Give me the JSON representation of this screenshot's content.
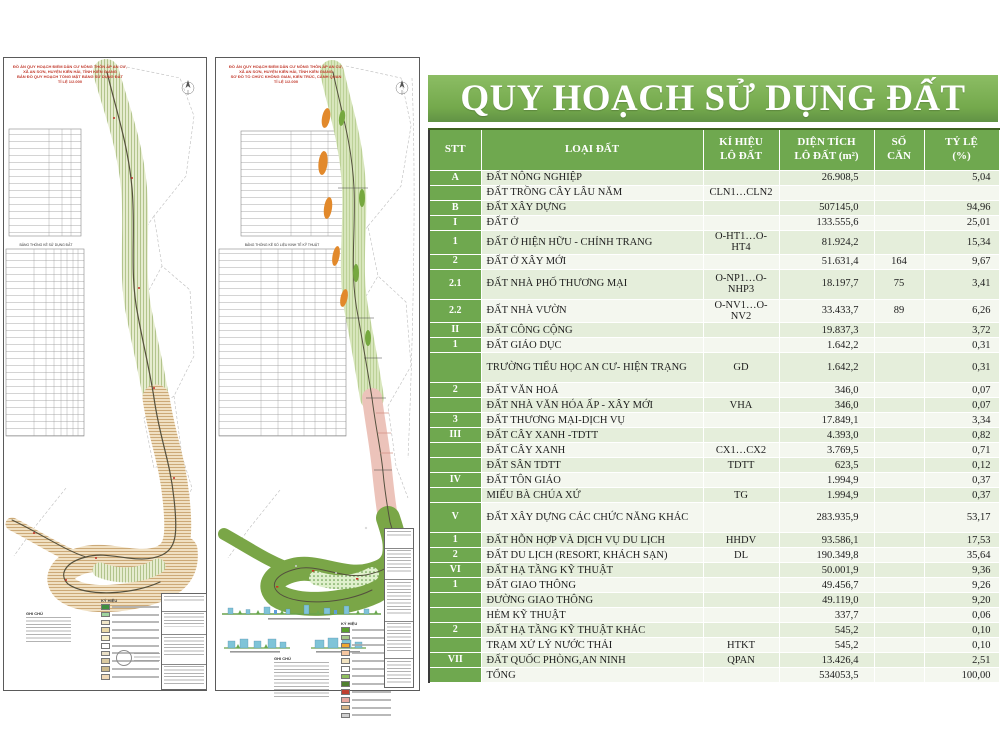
{
  "banner": {
    "title": "QUY HOẠCH SỬ DỤNG ĐẤT"
  },
  "colors": {
    "banner_green": "#74a94c",
    "header_green": "#6fa84f",
    "row_band_green": "#e5eedb",
    "row_band_light": "#f4f7ef",
    "map_tan": "#f0e0c2",
    "map_green_hatch": "#e6eccf",
    "map_solid_green": "#7aa647",
    "map_pink": "#ecc3ba",
    "map_orange": "#e2892b",
    "red_note_text": "#c23b2e"
  },
  "table": {
    "headers": {
      "stt": "STT",
      "loai": "LOẠI ĐẤT",
      "kihieu": "KÍ HIỆU\nLÔ ĐẤT",
      "dientich": "DIỆN TÍCH\nLÔ ĐẤT (m²)",
      "socan": "SỐ\nCĂN",
      "tyle": "TỶ LỆ\n(%)"
    },
    "rows": [
      {
        "stt": "A",
        "loai": "ĐẤT NÔNG NGHIỆP",
        "kihieu": "",
        "dientich": "26.908,5",
        "socan": "",
        "tyle": "5,04"
      },
      {
        "stt": "",
        "loai": "ĐẤT TRỒNG CÂY LÂU NĂM",
        "kihieu": "CLN1…CLN2",
        "dientich": "",
        "socan": "",
        "tyle": ""
      },
      {
        "stt": "B",
        "loai": "ĐẤT XÂY DỰNG",
        "kihieu": "",
        "dientich": "507145,0",
        "socan": "",
        "tyle": "94,96"
      },
      {
        "stt": "I",
        "loai": "ĐẤT Ở",
        "kihieu": "",
        "dientich": "133.555,6",
        "socan": "",
        "tyle": "25,01"
      },
      {
        "stt": "1",
        "loai": "ĐẤT Ở HIỆN HỮU - CHỈNH TRANG",
        "kihieu": "O-HT1…O-HT4",
        "dientich": "81.924,2",
        "socan": "",
        "tyle": "15,34"
      },
      {
        "stt": "2",
        "loai": "ĐẤT Ở XÂY MỚI",
        "kihieu": "",
        "dientich": "51.631,4",
        "socan": "164",
        "tyle": "9,67"
      },
      {
        "stt": "2.1",
        "loai": "ĐẤT NHÀ PHỐ THƯƠNG MẠI",
        "kihieu": "O-NP1…O-NHP3",
        "dientich": "18.197,7",
        "socan": "75",
        "tyle": "3,41",
        "tall": true
      },
      {
        "stt": "2.2",
        "loai": "ĐẤT NHÀ VƯỜN",
        "kihieu": "O-NV1…O-NV2",
        "dientich": "33.433,7",
        "socan": "89",
        "tyle": "6,26"
      },
      {
        "stt": "II",
        "loai": "ĐẤT CÔNG CỘNG",
        "kihieu": "",
        "dientich": "19.837,3",
        "socan": "",
        "tyle": "3,72"
      },
      {
        "stt": "1",
        "loai": "ĐẤT GIÁO DỤC",
        "kihieu": "",
        "dientich": "1.642,2",
        "socan": "",
        "tyle": "0,31"
      },
      {
        "stt": "",
        "loai": "TRƯỜNG TIỂU HỌC AN CƯ- HIỆN TRẠNG",
        "kihieu": "GD",
        "dientich": "1.642,2",
        "socan": "",
        "tyle": "0,31",
        "tall": true
      },
      {
        "stt": "2",
        "loai": "ĐẤT VĂN HOÁ",
        "kihieu": "",
        "dientich": "346,0",
        "socan": "",
        "tyle": "0,07"
      },
      {
        "stt": "",
        "loai": "ĐẤT NHÀ VĂN HÓA ẤP - XÂY MỚI",
        "kihieu": "VHA",
        "dientich": "346,0",
        "socan": "",
        "tyle": "0,07"
      },
      {
        "stt": "3",
        "loai": "ĐẤT THƯƠNG MẠI-DỊCH VỤ",
        "kihieu": "",
        "dientich": "17.849,1",
        "socan": "",
        "tyle": "3,34"
      },
      {
        "stt": "III",
        "loai": "ĐẤT CÂY XANH -TDTT",
        "kihieu": "",
        "dientich": "4.393,0",
        "socan": "",
        "tyle": "0,82"
      },
      {
        "stt": "",
        "loai": "ĐẤT CÂY XANH",
        "kihieu": "CX1…CX2",
        "dientich": "3.769,5",
        "socan": "",
        "tyle": "0,71"
      },
      {
        "stt": "",
        "loai": "ĐẤT SÂN TDTT",
        "kihieu": "TDTT",
        "dientich": "623,5",
        "socan": "",
        "tyle": "0,12"
      },
      {
        "stt": "IV",
        "loai": "ĐẤT TÔN GIÁO",
        "kihieu": "",
        "dientich": "1.994,9",
        "socan": "",
        "tyle": "0,37"
      },
      {
        "stt": "",
        "loai": "MIẾU BÀ CHÚA XỨ",
        "kihieu": "TG",
        "dientich": "1.994,9",
        "socan": "",
        "tyle": "0,37"
      },
      {
        "stt": "V",
        "loai": "ĐẤT XÂY DỰNG CÁC CHỨC NĂNG KHÁC",
        "kihieu": "",
        "dientich": "283.935,9",
        "socan": "",
        "tyle": "53,17",
        "tall": true
      },
      {
        "stt": "1",
        "loai": "ĐẤT HỖN HỢP VÀ DỊCH VỤ DU LỊCH",
        "kihieu": "HHDV",
        "dientich": "93.586,1",
        "socan": "",
        "tyle": "17,53"
      },
      {
        "stt": "2",
        "loai": "ĐẤT DU LỊCH (RESORT, KHÁCH SẠN)",
        "kihieu": "DL",
        "dientich": "190.349,8",
        "socan": "",
        "tyle": "35,64"
      },
      {
        "stt": "VI",
        "loai": "ĐẤT HẠ TẦNG KỸ THUẬT",
        "kihieu": "",
        "dientich": "50.001,9",
        "socan": "",
        "tyle": "9,36"
      },
      {
        "stt": "1",
        "loai": "ĐẤT GIAO THÔNG",
        "kihieu": "",
        "dientich": "49.456,7",
        "socan": "",
        "tyle": "9,26"
      },
      {
        "stt": "",
        "loai": "ĐƯỜNG GIAO THÔNG",
        "kihieu": "",
        "dientich": "49.119,0",
        "socan": "",
        "tyle": "9,20"
      },
      {
        "stt": "",
        "loai": "HẺM KỸ THUẬT",
        "kihieu": "",
        "dientich": "337,7",
        "socan": "",
        "tyle": "0,06"
      },
      {
        "stt": "2",
        "loai": "ĐẤT HẠ TẦNG KỸ THUẬT KHÁC",
        "kihieu": "",
        "dientich": "545,2",
        "socan": "",
        "tyle": "0,10"
      },
      {
        "stt": "",
        "loai": "TRẠM XỬ LÝ NƯỚC THẢI",
        "kihieu": "HTKT",
        "dientich": "545,2",
        "socan": "",
        "tyle": "0,10"
      },
      {
        "stt": "VII",
        "loai": "ĐẤT QUỐC PHÒNG,AN NINH",
        "kihieu": "QPAN",
        "dientich": "13.426,4",
        "socan": "",
        "tyle": "2,51"
      },
      {
        "stt": "",
        "loai": "TỔNG",
        "kihieu": "",
        "dientich": "534053,5",
        "socan": "",
        "tyle": "100,00"
      }
    ]
  },
  "panel1": {
    "header_lines": "ĐỒ ÁN QUY HOẠCH ĐIỂM DÂN CƯ NÔNG THÔN ẤP AN CƯ,\nXÃ AN SƠN, HUYỆN KIÊN HẢI, TỈNH KIÊN GIANG\nBẢN ĐỒ QUY HOẠCH TỔNG MẶT BẰNG SỬ DỤNG ĐẤT\nTỈ LỆ 1/2.000",
    "table_caption": "BẢNG THỐNG KÊ SỬ DỤNG ĐẤT",
    "legend_title": "KÝ HIỆU",
    "notes_title": "GHI CHÚ",
    "legend_colors": [
      "#3f8f3f",
      "#9fd49f",
      "#f0e6c8",
      "#e8d8a8",
      "#f5eec9",
      "#ffffff",
      "#e9dfc6",
      "#d9c9a0",
      "#cbb98c",
      "#f0d9b8"
    ]
  },
  "panel2": {
    "header_lines": "ĐỒ ÁN QUY HOẠCH ĐIỂM DÂN CƯ NÔNG THÔN ẤP AN CƯ,\nXÃ AN SƠN, HUYỆN KIÊN HẢI, TỈNH KIÊN GIANG\nSƠ ĐỒ TỔ CHỨC KHÔNG GIAN, KIẾN TRÚC, CẢNH QUAN\nTỈ LỆ 1/2.000",
    "table_caption": "BẢNG THỐNG KÊ SỐ LIỆU KINH TẾ KỸ THUẬT",
    "legend_title": "KÝ HIỆU",
    "notes_title": "GHI CHÚ",
    "legend_colors": [
      "#5aa02c",
      "#a8c88a",
      "#f0a830",
      "#f5c6a0",
      "#f2e3c0",
      "#ffffff",
      "#8fbf5f",
      "#4f7f2f",
      "#c04030",
      "#e8a8a0",
      "#d9b98a",
      "#cfcfcf"
    ]
  }
}
